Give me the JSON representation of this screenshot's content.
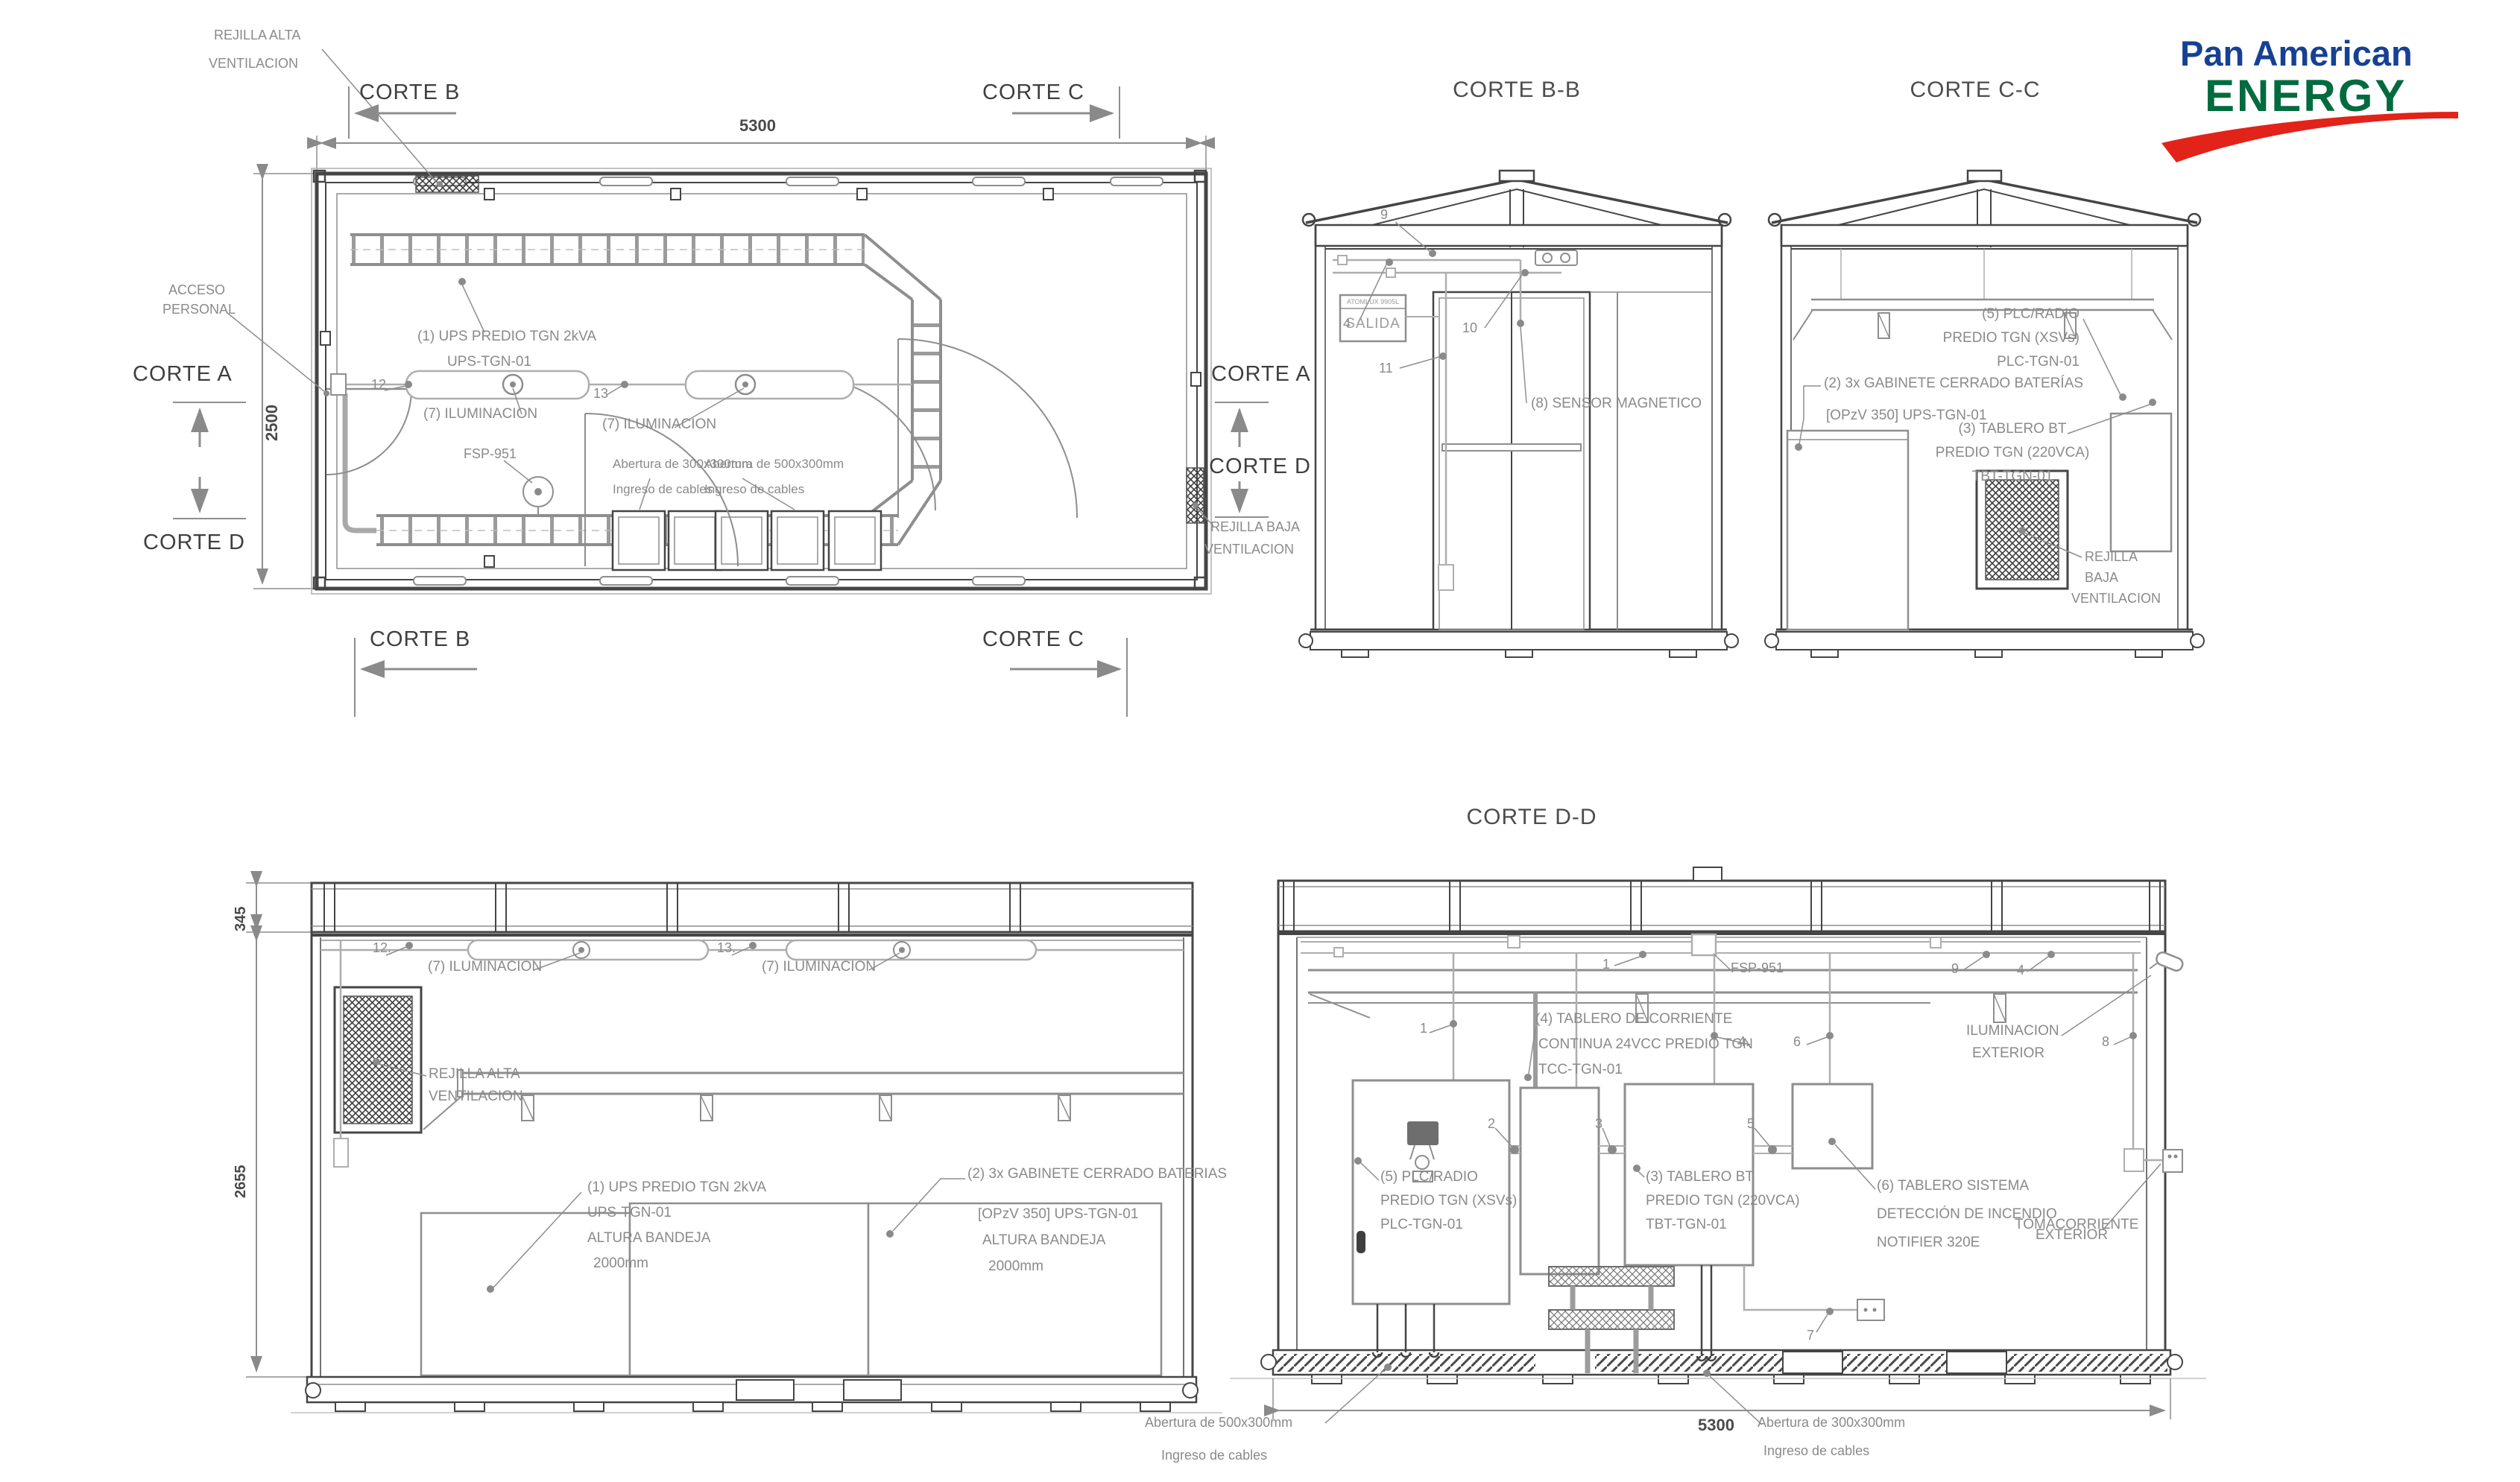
{
  "logo": {
    "line1": "Pan American",
    "line2": "ENERGY"
  },
  "colors": {
    "logo_blue": "#164193",
    "logo_green": "#006B3F",
    "logo_red": "#E2231A"
  },
  "plan": {
    "rejilla_alta_1": "REJILLA ALTA",
    "rejilla_alta_2": "VENTILACION",
    "corte_b": "CORTE B",
    "corte_c": "CORTE C",
    "corte_a": "CORTE A",
    "corte_d": "CORTE D",
    "dim_width": "5300",
    "dim_height": "2500",
    "acceso_1": "ACCESO",
    "acceso_2": "PERSONAL",
    "ups_1": "(1) UPS PREDIO TGN 2kVA",
    "ups_2": "UPS-TGN-01",
    "ilum_1": "(7) ILUMINACION",
    "ilum_2": "(7) ILUMINACION",
    "fsp": "FSP-951",
    "ab300_1": "Abertura de 300x300mm",
    "ab300_2": "Ingreso de cables",
    "ab500_1": "Abertura de 500x300mm",
    "ab500_2": "Ingreso de cables",
    "rejilla_baja_1": "REJILLA BAJA",
    "rejilla_baja_2": "VENTILACION",
    "m12": "12",
    "m13": "13"
  },
  "corte_bb": {
    "title": "CORTE B-B",
    "m9": "9",
    "m4": "4",
    "m10": "10",
    "m11": "11",
    "salida_brand": "ATOMLUX 9905L",
    "salida": "SALIDA",
    "sensor": "(8) SENSOR MAGNETICO"
  },
  "corte_cc": {
    "title": "CORTE C-C",
    "plc_1": "(5) PLC/RADIO",
    "plc_2": "PREDIO TGN (XSVs)",
    "plc_3": "PLC-TGN-01",
    "gab_1": "(2) 3x GABINETE CERRADO BATERÍAS",
    "gab_2": "[OPzV 350] UPS-TGN-01",
    "tbt_1": "(3) TABLERO BT",
    "tbt_2": "PREDIO TGN (220VCA)",
    "tbt_3": "TBT-TGN-01",
    "rej_1": "REJILLA",
    "rej_2": "BAJA",
    "rej_3": "VENTILACION"
  },
  "corte_aa": {
    "dim_roof": "345",
    "dim_wall": "2655",
    "m12": "12.",
    "m13": "13.",
    "ilum_1": "(7) ILUMINACION",
    "ilum_2": "(7) ILUMINACION",
    "rejilla_1": "REJILLA ALTA",
    "rejilla_2": "VENTILACION",
    "ups_1": "(1) UPS PREDIO TGN 2kVA",
    "ups_2": "UPS-TGN-01",
    "ups_3": "ALTURA BANDEJA",
    "ups_4": "2000mm",
    "gab_1": "(2) 3x GABINETE CERRADO BATERIAS",
    "gab_2": "[OPzV 350] UPS-TGN-01",
    "gab_3": "ALTURA BANDEJA",
    "gab_4": "2000mm"
  },
  "corte_dd": {
    "title": "CORTE D-D",
    "fsp": "FSP-951",
    "m1a": "1",
    "m1b": "1",
    "m9": "9",
    "m4a": "4",
    "m4b": "4.",
    "m6": "6",
    "m8": "8",
    "m2": "2",
    "m3": "3",
    "m5": "5",
    "m7": "7",
    "tcc_1": "(4) TABLERO DE CORRIENTE",
    "tcc_2": "CONTINUA 24VCC PREDIO TGN",
    "tcc_3": "TCC-TGN-01",
    "plc_1": "(5) PLC/RADIO",
    "plc_2": "PREDIO TGN (XSVs)",
    "plc_3": "PLC-TGN-01",
    "tbt_1": "(3) TABLERO BT",
    "tbt_2": "PREDIO TGN (220VCA)",
    "tbt_3": "TBT-TGN-01",
    "not_1": "(6) TABLERO SISTEMA",
    "not_2": "DETECCIÓN DE INCENDIO",
    "not_3": "NOTIFIER 320E",
    "ilum_ext_1": "ILUMINACION",
    "ilum_ext_2": "EXTERIOR",
    "toma_1": "TOMACORRIENTE",
    "toma_2": "EXTERIOR",
    "dim_width": "5300",
    "ab500_1": "Abertura de 500x300mm",
    "ab500_2": "Ingreso de cables",
    "ab300_1": "Abertura de 300x300mm",
    "ab300_2": "Ingreso de cables"
  }
}
